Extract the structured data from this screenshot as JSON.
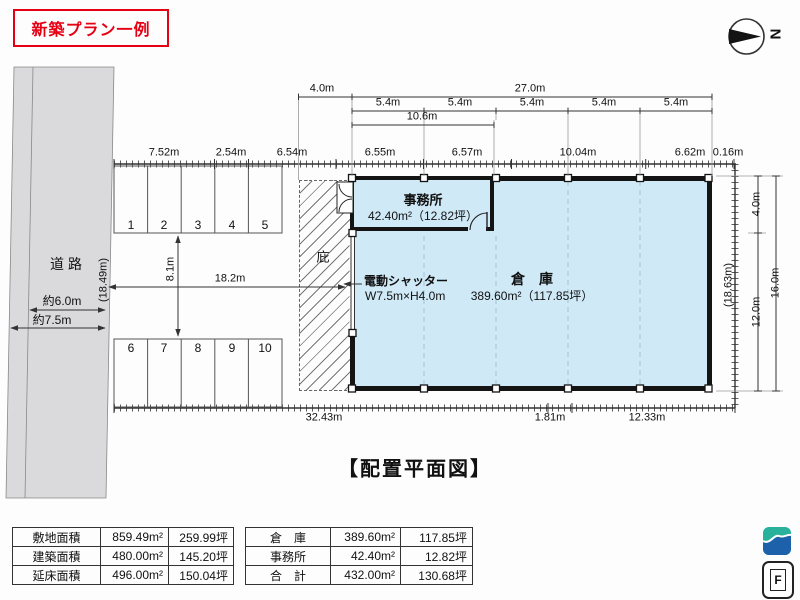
{
  "title": "新築プラン一例",
  "caption": "【配置平面図】",
  "compass": {
    "label": "N"
  },
  "logo": {
    "f_label": "F"
  },
  "colors": {
    "accent_red": "#e60014",
    "building_fill": "#cfe9f6",
    "road_fill": "#dadadd",
    "logo_teal": "#2ab19b",
    "logo_blue": "#1d61ab"
  },
  "plan_labels": [
    {
      "name": "dim-canopy-width",
      "text": "4.0m",
      "x": 322,
      "y": 89
    },
    {
      "name": "dim-building-width",
      "text": "27.0m",
      "x": 530,
      "y": 89
    },
    {
      "name": "dim-bay-1",
      "text": "5.4m",
      "x": 388,
      "y": 103
    },
    {
      "name": "dim-bay-2",
      "text": "5.4m",
      "x": 460,
      "y": 103
    },
    {
      "name": "dim-bay-3",
      "text": "5.4m",
      "x": 532,
      "y": 103
    },
    {
      "name": "dim-bay-4",
      "text": "5.4m",
      "x": 604,
      "y": 103
    },
    {
      "name": "dim-bay-5",
      "text": "5.4m",
      "x": 676,
      "y": 103
    },
    {
      "name": "dim-office-width",
      "text": "10.6m",
      "x": 422,
      "y": 117
    },
    {
      "name": "dim-boundary-seg-1",
      "text": "7.52m",
      "x": 164,
      "y": 153
    },
    {
      "name": "dim-boundary-seg-2",
      "text": "2.54m",
      "x": 231,
      "y": 153
    },
    {
      "name": "dim-boundary-seg-3",
      "text": "6.54m",
      "x": 292,
      "y": 153
    },
    {
      "name": "dim-boundary-seg-4",
      "text": "6.55m",
      "x": 380,
      "y": 153
    },
    {
      "name": "dim-boundary-seg-5",
      "text": "6.57m",
      "x": 467,
      "y": 153
    },
    {
      "name": "dim-boundary-seg-6",
      "text": "10.04m",
      "x": 578,
      "y": 153
    },
    {
      "name": "dim-boundary-seg-7",
      "text": "6.62m",
      "x": 690,
      "y": 153
    },
    {
      "name": "dim-boundary-seg-8",
      "text": "0.16m",
      "x": 728,
      "y": 153
    },
    {
      "name": "dim-bottom-1",
      "text": "32.43m",
      "x": 324,
      "y": 418
    },
    {
      "name": "dim-bottom-2",
      "text": "1.81m",
      "x": 550,
      "y": 418
    },
    {
      "name": "dim-bottom-3",
      "text": "12.33m",
      "x": 647,
      "y": 418
    },
    {
      "name": "dim-office-depth",
      "text": "4.0m",
      "x": 757,
      "y": 204,
      "rot": -90
    },
    {
      "name": "dim-warehouse-depth",
      "text": "12.0m",
      "x": 757,
      "y": 312,
      "rot": -90
    },
    {
      "name": "dim-building-depth",
      "text": "16.0m",
      "x": 776,
      "y": 283,
      "rot": -90
    },
    {
      "name": "dim-east-boundary",
      "text": "(18.63m)",
      "x": 729,
      "y": 285,
      "rot": -90
    },
    {
      "name": "dim-west-boundary",
      "text": "(18.49m)",
      "x": 104,
      "y": 280,
      "rot": -90
    },
    {
      "name": "dim-yard-depth",
      "text": "8.1m",
      "x": 171,
      "y": 269,
      "rot": -90
    },
    {
      "name": "dim-yard-width",
      "text": "18.2m",
      "x": 230,
      "y": 279
    },
    {
      "name": "road-label",
      "text": "道 路",
      "x": 66,
      "y": 264,
      "size": 14
    },
    {
      "name": "road-width-1",
      "text": "約6.0m",
      "x": 62,
      "y": 301,
      "size": 12
    },
    {
      "name": "road-width-2",
      "text": "約7.5m",
      "x": 52,
      "y": 320,
      "size": 12
    },
    {
      "name": "canopy-label",
      "text": "庇",
      "x": 323,
      "y": 257,
      "size": 13
    },
    {
      "name": "shutter-label",
      "text": "電動シャッター",
      "x": 364,
      "y": 281,
      "size": 12,
      "bold": true,
      "align": "left"
    },
    {
      "name": "shutter-size",
      "text": "W7.5m×H4.0m",
      "x": 365,
      "y": 296,
      "size": 12,
      "align": "left"
    },
    {
      "name": "office-label",
      "text": "事務所",
      "x": 423,
      "y": 200,
      "size": 13,
      "bold": true
    },
    {
      "name": "office-area",
      "text": "42.40m²（12.82坪）",
      "x": 423,
      "y": 216,
      "size": 12
    },
    {
      "name": "warehouse-label",
      "text": "倉　庫",
      "x": 532,
      "y": 279,
      "size": 14,
      "bold": true
    },
    {
      "name": "warehouse-area",
      "text": "389.60m²（117.85坪）",
      "x": 532,
      "y": 296,
      "size": 12
    },
    {
      "name": "parking-space-1",
      "text": "1",
      "x": 131,
      "y": 225,
      "size": 12
    },
    {
      "name": "parking-space-2",
      "text": "2",
      "x": 164,
      "y": 225,
      "size": 12
    },
    {
      "name": "parking-space-3",
      "text": "3",
      "x": 198,
      "y": 225,
      "size": 12
    },
    {
      "name": "parking-space-4",
      "text": "4",
      "x": 232,
      "y": 225,
      "size": 12
    },
    {
      "name": "parking-space-5",
      "text": "5",
      "x": 265,
      "y": 225,
      "size": 12
    },
    {
      "name": "parking-space-6",
      "text": "6",
      "x": 131,
      "y": 348,
      "size": 12
    },
    {
      "name": "parking-space-7",
      "text": "7",
      "x": 164,
      "y": 348,
      "size": 12
    },
    {
      "name": "parking-space-8",
      "text": "8",
      "x": 198,
      "y": 348,
      "size": 12
    },
    {
      "name": "parking-space-9",
      "text": "9",
      "x": 232,
      "y": 348,
      "size": 12
    },
    {
      "name": "parking-space-10",
      "text": "10",
      "x": 265,
      "y": 348,
      "size": 12
    }
  ],
  "site_table": {
    "rows": [
      [
        "敷地面積",
        "859.49m²",
        "259.99坪"
      ],
      [
        "建築面積",
        "480.00m²",
        "145.20坪"
      ],
      [
        "延床面積",
        "496.00m²",
        "150.04坪"
      ]
    ]
  },
  "building_table": {
    "rows": [
      [
        "倉　庫",
        "389.60m²",
        "117.85坪"
      ],
      [
        "事務所",
        "42.40m²",
        "12.82坪"
      ],
      [
        "合　計",
        "432.00m²",
        "130.68坪"
      ]
    ]
  }
}
